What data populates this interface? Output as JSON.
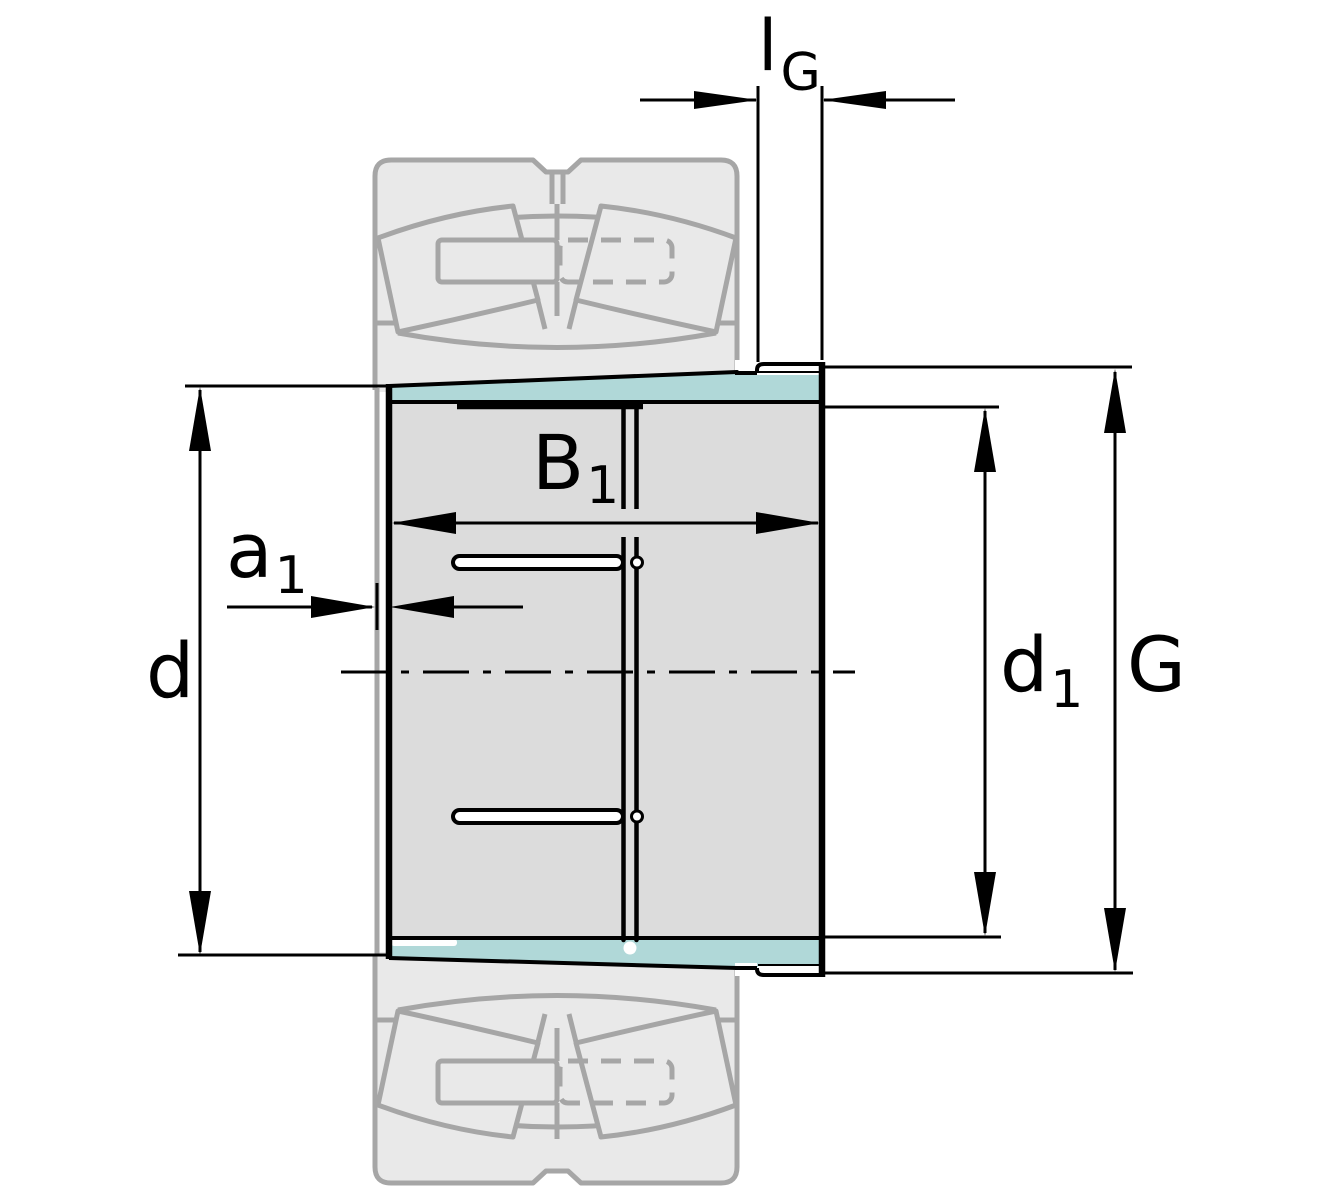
{
  "figure": {
    "dimension_labels": {
      "lG": {
        "main": "l",
        "sub": "G"
      },
      "B1": {
        "main": "B",
        "sub": "1"
      },
      "a1": {
        "main": "a",
        "sub": "1"
      },
      "d": {
        "main": "d",
        "sub": ""
      },
      "d1": {
        "main": "d",
        "sub": "1"
      },
      "G": {
        "main": "G",
        "sub": ""
      }
    },
    "colors": {
      "highlight": "#b0d8d8",
      "sleeve_fill": "#dcdcdc",
      "ghost_fill": "#e9e9e9",
      "ghost_stroke": "#a6a6a6",
      "line": "#000000",
      "background": "#ffffff"
    }
  }
}
